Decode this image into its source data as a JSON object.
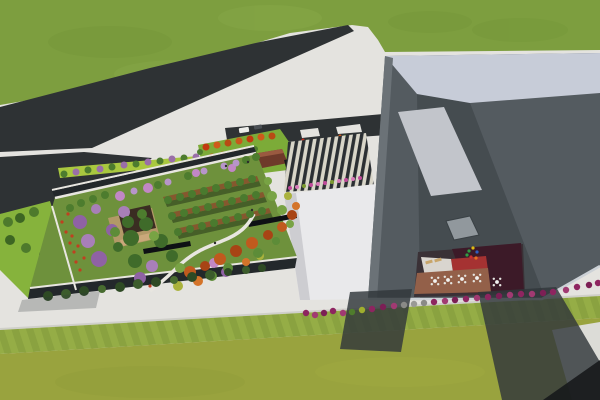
{
  "scene": {
    "colors": {
      "pavement": "#e4e3df",
      "grass_top": "#7d9e3f",
      "grass_top_shade": "#74953a",
      "grass_top_light": "#89a94a",
      "grass_bottom": "#99a33e",
      "grass_stripe_a": "#8aa240",
      "grass_stripe_b": "#95ad46",
      "lawn_strip": "#86b33c",
      "lime_strip": "#a9c83f",
      "entrance_lawn": "#7cab38",
      "garden_lawn": "#6e913c",
      "road": "#2e3234",
      "white_building": "#e9e9eb",
      "white_building_shade": "#cdcdd1",
      "roof_band": "#c7ccd8",
      "face_dark": "#454c50",
      "face_mid": "#545b60",
      "left_edge": "#6b7277",
      "skylight": "#c2c5cb",
      "panel_small": "#91989d",
      "facade_dark": "#23282b",
      "courtyard_maroon": "#3c1a28",
      "courtyard_red": "#a53232",
      "courtyard_white": "#d9d5cf",
      "terrace_brown": "#936049",
      "pavilion_brown": "#6e3a2a",
      "pavilion_deck": "#b99a6c",
      "pavilion_dark": "#3a2d22",
      "canopy_dark": "#17191b",
      "shadow": "#31373a",
      "shadow_dark": "#17191c",
      "path_white": "#e8e6e0",
      "planter_brown": "#8a4e2c",
      "bench_dark": "#0e1114",
      "plaza_dark": "#2b2f33",
      "plaza_light": "#d8d5c8",
      "curb_light": "#cfcfc9"
    },
    "garden_trees": [
      [
        80,
        222,
        7,
        "#8f62a4"
      ],
      [
        99,
        259,
        8,
        "#8f62a4"
      ],
      [
        112,
        230,
        6,
        "#8f62a4"
      ],
      [
        140,
        278,
        6,
        "#8f62a4"
      ],
      [
        226,
        272,
        5,
        "#8f62a4"
      ],
      [
        88,
        241,
        7,
        "#a87fb8"
      ],
      [
        124,
        212,
        6,
        "#a87fb8"
      ],
      [
        152,
        266,
        6,
        "#a87fb8"
      ],
      [
        96,
        209,
        5,
        "#a87fb8"
      ],
      [
        120,
        196,
        5,
        "#c287c5"
      ],
      [
        148,
        188,
        5,
        "#c287c5"
      ],
      [
        196,
        173,
        4,
        "#c287c5"
      ],
      [
        214,
        263,
        5,
        "#c287c5"
      ],
      [
        232,
        168,
        4,
        "#c287c5"
      ],
      [
        134,
        191,
        3.5,
        "#b795c9"
      ],
      [
        168,
        182,
        3.5,
        "#b795c9"
      ],
      [
        204,
        171,
        3.5,
        "#b795c9"
      ],
      [
        224,
        166,
        3.5,
        "#b795c9"
      ],
      [
        236,
        163,
        3.5,
        "#b795c9"
      ],
      [
        70,
        208,
        4,
        "#4d7c2e"
      ],
      [
        81,
        203,
        4,
        "#4d7c2e"
      ],
      [
        93,
        199,
        4,
        "#4d7c2e"
      ],
      [
        105,
        195,
        4,
        "#4d7c2e"
      ],
      [
        158,
        185,
        4,
        "#4d7c2e"
      ],
      [
        188,
        176,
        4,
        "#4d7c2e"
      ],
      [
        246,
        160,
        4,
        "#4d7c2e"
      ],
      [
        256,
        157,
        4,
        "#4d7c2e"
      ],
      [
        131,
        238,
        8,
        "#3f6b2a"
      ],
      [
        146,
        224,
        7,
        "#3f6b2a"
      ],
      [
        161,
        241,
        7,
        "#3f6b2a"
      ],
      [
        135,
        261,
        7,
        "#3f6b2a"
      ],
      [
        172,
        256,
        6,
        "#3f6b2a"
      ],
      [
        118,
        247,
        5,
        "#3f6b2a"
      ],
      [
        154,
        236,
        5,
        "#78a344"
      ],
      [
        180,
        268,
        5,
        "#78a344"
      ],
      [
        272,
        196,
        5,
        "#78a344"
      ],
      [
        282,
        210,
        5,
        "#78a344"
      ],
      [
        290,
        224,
        4,
        "#78a344"
      ],
      [
        268,
        181,
        4,
        "#78a344"
      ],
      [
        168,
        200,
        4,
        "#4a7a2e"
      ],
      [
        180,
        197,
        4,
        "#4a7a2e"
      ],
      [
        192,
        194,
        4,
        "#4a7a2e"
      ],
      [
        204,
        191,
        4,
        "#4a7a2e"
      ],
      [
        216,
        188,
        4,
        "#4a7a2e"
      ],
      [
        228,
        185,
        4,
        "#4a7a2e"
      ],
      [
        240,
        182,
        4,
        "#4a7a2e"
      ],
      [
        252,
        179,
        4,
        "#4a7a2e"
      ],
      [
        172,
        216,
        4,
        "#4a7a2e"
      ],
      [
        184,
        213,
        4,
        "#4a7a2e"
      ],
      [
        196,
        210,
        4,
        "#4a7a2e"
      ],
      [
        208,
        207,
        4,
        "#4a7a2e"
      ],
      [
        220,
        204,
        4,
        "#4a7a2e"
      ],
      [
        232,
        201,
        4,
        "#4a7a2e"
      ],
      [
        244,
        198,
        4,
        "#4a7a2e"
      ],
      [
        256,
        195,
        4,
        "#4a7a2e"
      ],
      [
        178,
        232,
        4,
        "#4a7a2e"
      ],
      [
        190,
        229,
        4,
        "#4a7a2e"
      ],
      [
        202,
        226,
        4,
        "#4a7a2e"
      ],
      [
        214,
        223,
        4,
        "#4a7a2e"
      ],
      [
        226,
        220,
        4,
        "#4a7a2e"
      ],
      [
        238,
        217,
        4,
        "#4a7a2e"
      ],
      [
        250,
        214,
        4,
        "#4a7a2e"
      ],
      [
        262,
        211,
        4,
        "#4a7a2e"
      ],
      [
        190,
        272,
        6,
        "#c05a1e"
      ],
      [
        220,
        259,
        6,
        "#c05a1e"
      ],
      [
        252,
        243,
        6,
        "#c05a1e"
      ],
      [
        282,
        227,
        5,
        "#c05a1e"
      ],
      [
        205,
        266,
        5,
        "#a84415"
      ],
      [
        236,
        251,
        6,
        "#a84415"
      ],
      [
        268,
        235,
        5,
        "#a84415"
      ],
      [
        292,
        215,
        5,
        "#a84415"
      ],
      [
        198,
        281,
        5,
        "#d4742a"
      ],
      [
        246,
        262,
        4,
        "#d4742a"
      ],
      [
        296,
        206,
        4,
        "#d4742a"
      ],
      [
        178,
        286,
        5,
        "#aab23c"
      ],
      [
        260,
        256,
        4,
        "#aab23c"
      ],
      [
        288,
        196,
        4,
        "#aab23c"
      ],
      [
        212,
        276,
        5,
        "#5d8c38"
      ],
      [
        228,
        268,
        5,
        "#5d8c38"
      ],
      [
        258,
        253,
        5,
        "#5d8c38"
      ],
      [
        276,
        241,
        4,
        "#5d8c38"
      ],
      [
        128,
        222,
        6,
        "#3f6b2a"
      ],
      [
        142,
        214,
        5,
        "#4d7c2e"
      ],
      [
        115,
        232,
        5,
        "#5d8c38"
      ]
    ],
    "facade_trees": [
      [
        48,
        296,
        5,
        "#2e4a24"
      ],
      [
        66,
        294,
        5,
        "#3c5c2c"
      ],
      [
        84,
        291,
        5,
        "#2e4a24"
      ],
      [
        102,
        289,
        4,
        "#486c30"
      ],
      [
        120,
        287,
        5,
        "#2e4a24"
      ],
      [
        138,
        284,
        5,
        "#3c5c2c"
      ],
      [
        156,
        282,
        5,
        "#2e4a24"
      ],
      [
        174,
        280,
        4,
        "#486c30"
      ],
      [
        192,
        277,
        5,
        "#2e4a24"
      ],
      [
        210,
        275,
        5,
        "#3c5c2c"
      ],
      [
        228,
        272,
        4,
        "#2e4a24"
      ],
      [
        246,
        270,
        4,
        "#3c5c2c"
      ],
      [
        262,
        268,
        4,
        "#2e4a24"
      ]
    ],
    "street_trees": [
      [
        64,
        174,
        3.5,
        "#4d7c2e"
      ],
      [
        76,
        172,
        3.5,
        "#9a6fa8"
      ],
      [
        88,
        170,
        3.5,
        "#4d7c2e"
      ],
      [
        100,
        169,
        3.5,
        "#9a6fa8"
      ],
      [
        112,
        167,
        3.5,
        "#4d7c2e"
      ],
      [
        124,
        165,
        3.5,
        "#9a6fa8"
      ],
      [
        136,
        164,
        3.5,
        "#4d7c2e"
      ],
      [
        148,
        162,
        3.5,
        "#9a6fa8"
      ],
      [
        160,
        161,
        3.5,
        "#4d7c2e"
      ],
      [
        172,
        159,
        3.5,
        "#9a6fa8"
      ],
      [
        184,
        158,
        3.5,
        "#4d7c2e"
      ],
      [
        196,
        157,
        3.5,
        "#9a6fa8"
      ]
    ],
    "red_trees": [
      [
        206,
        147,
        3.5,
        "#c23a10"
      ],
      [
        217,
        145,
        3.5,
        "#d05a1a"
      ],
      [
        228,
        143,
        3.5,
        "#b84a14"
      ],
      [
        239,
        141,
        3.5,
        "#c8581c"
      ],
      [
        250,
        139,
        3.5,
        "#c23a10"
      ],
      [
        261,
        137,
        3.5,
        "#d05a1a"
      ],
      [
        272,
        136,
        3.5,
        "#b84a14"
      ],
      [
        212,
        157,
        3.5,
        "#c8581c"
      ],
      [
        223,
        155,
        3.5,
        "#c23a10"
      ],
      [
        234,
        153,
        3.5,
        "#d05a1a"
      ],
      [
        245,
        151,
        3.5,
        "#b84a14"
      ],
      [
        200,
        152,
        3,
        "#4d7c2e"
      ],
      [
        255,
        149,
        3,
        "#4d7c2e"
      ]
    ],
    "left_bushes": [
      [
        8,
        222,
        5,
        "#4e7a2c"
      ],
      [
        20,
        218,
        5,
        "#3d6623"
      ],
      [
        34,
        212,
        5,
        "#4e7a2c"
      ],
      [
        10,
        240,
        5,
        "#3d6623"
      ],
      [
        26,
        248,
        5,
        "#4e7a2c"
      ],
      [
        44,
        255,
        5,
        "#3d6623"
      ]
    ],
    "ground_flowers": [
      [
        62,
        222
      ],
      [
        66,
        232
      ],
      [
        70,
        243
      ],
      [
        74,
        252
      ],
      [
        68,
        214
      ],
      [
        76,
        262
      ],
      [
        80,
        270
      ],
      [
        72,
        236
      ],
      [
        78,
        246
      ],
      [
        84,
        258
      ],
      [
        150,
        286
      ],
      [
        158,
        280
      ]
    ],
    "shrubs": [
      [
        306,
        313,
        3.2,
        "#8e2560"
      ],
      [
        315,
        315,
        3.2,
        "#a13a72"
      ],
      [
        324,
        313,
        3.2,
        "#7c1f55"
      ],
      [
        333,
        311,
        3.2,
        "#8e2560"
      ],
      [
        343,
        313,
        3.2,
        "#a13a72"
      ],
      [
        352,
        312,
        3.2,
        "#4f7c2c"
      ],
      [
        362,
        310,
        3.2,
        "#9fae2e"
      ],
      [
        372,
        309,
        3.2,
        "#8e2560"
      ],
      [
        383,
        307,
        3.2,
        "#7c1f55"
      ],
      [
        394,
        306,
        3.2,
        "#a13a72"
      ],
      [
        404,
        305,
        3.2,
        "#8a8a86"
      ],
      [
        414,
        304,
        3.2,
        "#9a9a96"
      ],
      [
        424,
        303,
        3.2,
        "#8a8a86"
      ],
      [
        434,
        302,
        3.2,
        "#8e2560"
      ],
      [
        445,
        301,
        3.2,
        "#a13a72"
      ],
      [
        455,
        300,
        3.2,
        "#7c1f55"
      ],
      [
        466,
        299,
        3.2,
        "#8e2560"
      ],
      [
        477,
        298,
        3.2,
        "#a13a72"
      ],
      [
        488,
        297,
        3.2,
        "#8e2560"
      ],
      [
        499,
        296,
        3.2,
        "#7c1f55"
      ],
      [
        510,
        295,
        3.2,
        "#a13a72"
      ],
      [
        521,
        294,
        3.2,
        "#8e2560"
      ],
      [
        532,
        294,
        3.2,
        "#a13a72"
      ],
      [
        543,
        293,
        3.2,
        "#7c1f55"
      ],
      [
        553,
        292,
        3.2,
        "#8e2560"
      ],
      [
        566,
        290,
        3.2,
        "#a13a72"
      ],
      [
        577,
        287,
        3.2,
        "#8e2560"
      ],
      [
        589,
        285,
        3.2,
        "#7c1f55"
      ],
      [
        598,
        283,
        3.2,
        "#8e2560"
      ]
    ],
    "plaza_flowers": [
      [
        290,
        188,
        "#c04a9a"
      ],
      [
        297,
        187,
        "#d77ab8"
      ],
      [
        304,
        186,
        "#7c9a30"
      ],
      [
        311,
        185,
        "#c04a9a"
      ],
      [
        318,
        184,
        "#d77ab8"
      ],
      [
        325,
        183,
        "#c04a9a"
      ],
      [
        332,
        182,
        "#7c9a30"
      ],
      [
        339,
        181,
        "#d77ab8"
      ],
      [
        346,
        180,
        "#c04a9a"
      ],
      [
        353,
        179,
        "#d77ab8"
      ],
      [
        360,
        178,
        "#c04a9a"
      ]
    ],
    "island_flowers": [
      [
        303,
        140,
        "#c03020"
      ],
      [
        307,
        141,
        "#3f6b2a"
      ],
      [
        311,
        141,
        "#d05a1a"
      ],
      [
        315,
        142,
        "#3f6b2a"
      ],
      [
        319,
        142,
        "#c03020"
      ],
      [
        340,
        136,
        "#d05a1a"
      ],
      [
        345,
        136,
        "#3f6b2a"
      ],
      [
        350,
        137,
        "#c03020"
      ],
      [
        355,
        137,
        "#3f6b2a"
      ],
      [
        359,
        138,
        "#d05a1a"
      ]
    ],
    "tables": [
      [
        435,
        281
      ],
      [
        448,
        280
      ],
      [
        462,
        279
      ],
      [
        477,
        278
      ],
      [
        497,
        282
      ]
    ],
    "loungers": [
      [
        429,
        262,
        -15
      ],
      [
        438,
        260,
        -15
      ]
    ],
    "playground": [
      [
        469,
        251,
        "#2f9e44"
      ],
      [
        473,
        248,
        "#e0bb12"
      ],
      [
        477,
        252,
        "#2f5fc0"
      ],
      [
        471,
        257,
        "#c83030"
      ],
      [
        476,
        258,
        "#e87020"
      ],
      [
        467,
        255,
        "#2f9e44"
      ]
    ],
    "people": [
      [
        226,
        166
      ],
      [
        248,
        162
      ],
      [
        215,
        243
      ],
      [
        252,
        210
      ]
    ],
    "vehicles": [
      [
        244,
        130,
        10,
        5,
        -9,
        "#ededea"
      ],
      [
        258,
        127,
        8,
        4,
        -9,
        "#4a4f54"
      ]
    ]
  }
}
